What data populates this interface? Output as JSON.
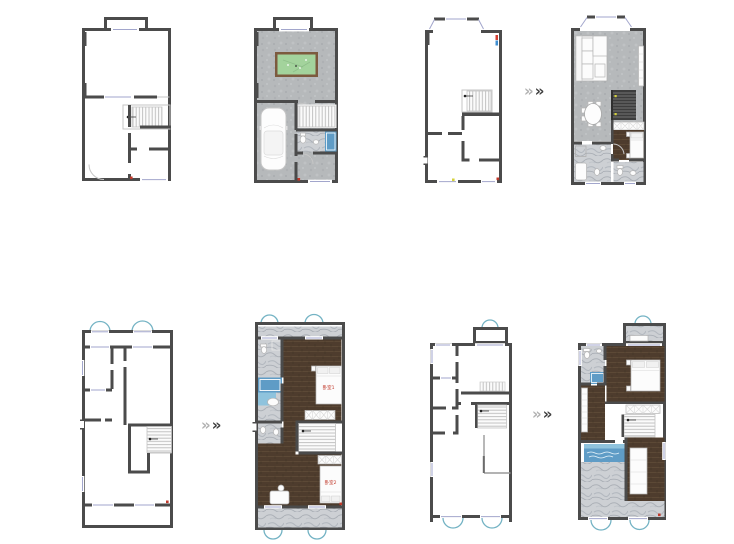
{
  "board": {
    "background": "#ffffff"
  },
  "labels": {
    "bedroom1": "卧室1",
    "bedroom2": "卧室2"
  },
  "arrow": {
    "first": "»",
    "second": "»"
  },
  "colors": {
    "wall": "#4b4b4b",
    "floor": "#b6b9bb",
    "marble": "#cdd0d4",
    "wood": "#4e3c2d",
    "water": "#5f9cc6",
    "water_light": "#8fc3dd",
    "pool_green": "#a3d39c",
    "pool_rim": "#7c5a3e",
    "window": "#a2a6cc",
    "arch": "#74b3c4",
    "label_red": "#c0392b",
    "accent_yellow": "#d6d23c",
    "arrow_light": "#b2b2b2",
    "arrow_dark": "#3e3e3e"
  },
  "plans": [
    {
      "id": "p1",
      "name": "floor-1-original-plan",
      "variant": "original"
    },
    {
      "id": "p2",
      "name": "floor-1-furnished-plan",
      "variant": "furnished"
    },
    {
      "id": "p3",
      "name": "floor-2-original-plan",
      "variant": "original"
    },
    {
      "id": "p4",
      "name": "floor-2-furnished-plan",
      "variant": "furnished"
    },
    {
      "id": "p5",
      "name": "floor-3-original-plan",
      "variant": "original"
    },
    {
      "id": "p6",
      "name": "floor-3-furnished-plan",
      "variant": "furnished"
    },
    {
      "id": "p7",
      "name": "floor-4-original-plan",
      "variant": "original"
    },
    {
      "id": "p8",
      "name": "floor-4-furnished-plan",
      "variant": "furnished"
    }
  ]
}
